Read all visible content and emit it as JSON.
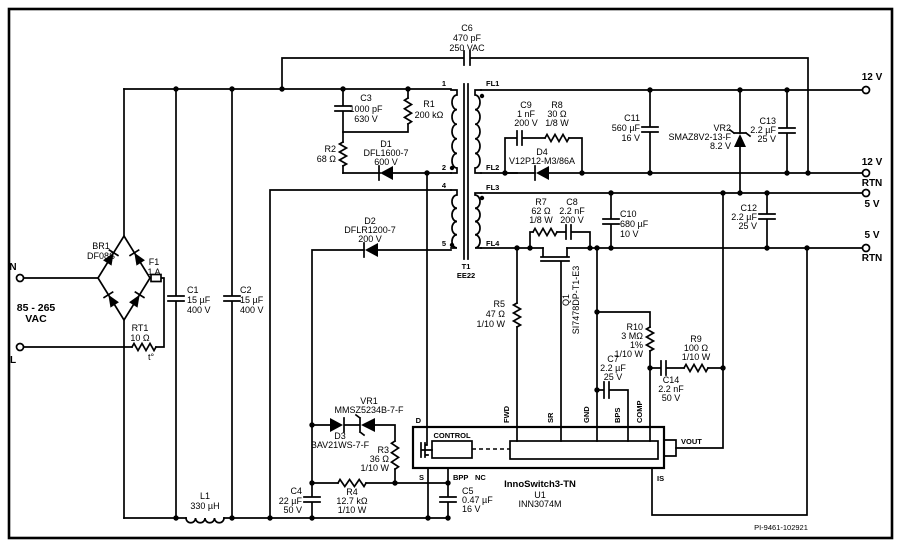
{
  "meta": {
    "doc_id": "PI-9461-102921"
  },
  "io": {
    "n": "N",
    "l": "L",
    "range1": "85 - 265",
    "range2": "VAC",
    "v12": "12 V",
    "v12r1": "12 V",
    "v12r2": "RTN",
    "v5": "5 V",
    "v5r1": "5 V",
    "v5r2": "RTN"
  },
  "components": {
    "c1": {
      "ref": "C1",
      "val": "15 µF",
      "rat": "400 V"
    },
    "c2": {
      "ref": "C2",
      "val": "15 µF",
      "rat": "400 V"
    },
    "c3": {
      "ref": "C3",
      "val": "1000 pF",
      "rat": "630 V"
    },
    "c4": {
      "ref": "C4",
      "val": "22 µF",
      "rat": "50 V"
    },
    "c5": {
      "ref": "C5",
      "val": "0.47 µF",
      "rat": "16 V"
    },
    "c6": {
      "ref": "C6",
      "val": "470 pF",
      "rat": "250 VAC"
    },
    "c7": {
      "ref": "C7",
      "val": "2.2 µF",
      "rat": "25 V"
    },
    "c8": {
      "ref": "C8",
      "val": "2.2 nF",
      "rat": "200 V"
    },
    "c9": {
      "ref": "C9",
      "val": "1 nF",
      "rat": "200 V"
    },
    "c10": {
      "ref": "C10",
      "val": "680 µF",
      "rat": "10 V"
    },
    "c11": {
      "ref": "C11",
      "val": "560 µF",
      "rat": "16 V"
    },
    "c12": {
      "ref": "C12",
      "val": "2.2 µF",
      "rat": "25 V"
    },
    "c13": {
      "ref": "C13",
      "val": "2.2 µF",
      "rat": "25 V"
    },
    "c14": {
      "ref": "C14",
      "val": "2.2 nF",
      "rat": "50 V"
    },
    "r1": {
      "ref": "R1",
      "val": "200 kΩ"
    },
    "r2": {
      "ref": "R2",
      "val": "68 Ω"
    },
    "r3": {
      "ref": "R3",
      "val": "36 Ω",
      "rat": "1/10 W"
    },
    "r4": {
      "ref": "R4",
      "val": "12.7 kΩ",
      "rat": "1/10 W"
    },
    "r5": {
      "ref": "R5",
      "val": "47 Ω",
      "rat": "1/10 W"
    },
    "r7": {
      "ref": "R7",
      "val": "62 Ω",
      "rat": "1/8 W"
    },
    "r8": {
      "ref": "R8",
      "val": "30 Ω",
      "rat": "1/8 W"
    },
    "r9": {
      "ref": "R9",
      "val": "100 Ω",
      "rat": "1/10 W"
    },
    "r10": {
      "ref": "R10",
      "val": "3 MΩ",
      "tol": "1%",
      "rat": "1/10 W"
    },
    "d1": {
      "ref": "D1",
      "part": "DFL1600-7",
      "rat": "600 V"
    },
    "d2": {
      "ref": "D2",
      "part": "DFLR1200-7",
      "rat": "200 V"
    },
    "d3": {
      "ref": "D3",
      "part": "BAV21WS-7-F"
    },
    "d4": {
      "ref": "D4",
      "part": "V12P12-M3/86A"
    },
    "vr1": {
      "ref": "VR1",
      "part": "MMSZ5234B-7-F"
    },
    "vr2": {
      "ref": "VR2",
      "part": "SMAZ8V2-13-F",
      "rat": "8.2 V"
    },
    "br1": {
      "ref": "BR1",
      "part": "DF08S"
    },
    "f1": {
      "ref": "F1",
      "val": "1 A"
    },
    "rt1": {
      "ref": "RT1",
      "val": "10 Ω",
      "note": "t°"
    },
    "l1": {
      "ref": "L1",
      "val": "330 µH"
    },
    "q1": {
      "ref": "Q1",
      "part": "SI7478DP-T1-E3"
    },
    "t1": {
      "ref": "T1",
      "part": "EE22",
      "p1": "1",
      "p2": "2",
      "p4": "4",
      "p5": "5",
      "fl1": "FL1",
      "fl2": "FL2",
      "fl3": "FL3",
      "fl4": "FL4"
    }
  },
  "ic": {
    "family": "InnoSwitch3-TN",
    "ref": "U1",
    "part": "INN3074M",
    "control": "CONTROL",
    "d": "D",
    "s": "S",
    "bpp": "BPP",
    "nc": "NC",
    "fwd": "FWD",
    "sr": "SR",
    "gnd": "GND",
    "bps": "BPS",
    "comp": "COMP",
    "vout": "VOUT",
    "is": "IS"
  }
}
